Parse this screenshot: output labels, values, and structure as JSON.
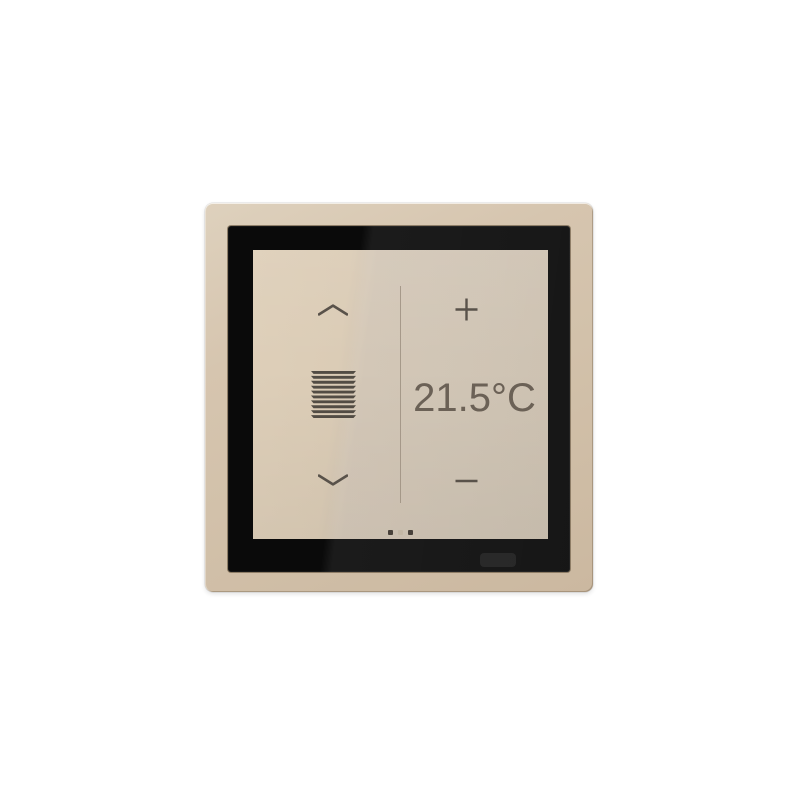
{
  "device": {
    "type": "knx-room-controller-touch-panel",
    "panes": {
      "blinds": {
        "up_icon": "chevron-up-icon",
        "state_icon": "venetian-blinds-icon",
        "down_icon": "chevron-down-icon"
      },
      "climate": {
        "increase_icon": "plus-icon",
        "temperature_value": "21.5°C",
        "decrease_icon": "minus-icon"
      }
    },
    "page_indicator": {
      "count": 3,
      "dots": [
        "dark",
        "light",
        "dark"
      ]
    },
    "sensor": "proximity-sensor-window",
    "colors": {
      "page_background": "#ffffff",
      "frame": "#d4c3ad",
      "bezel": "#0a0a0a",
      "screen_light": "#dccdb7",
      "screen_dark": "#ccc0af",
      "glyph": "#59524a",
      "temperature_text": "#6b6156",
      "divider": "#9e9181",
      "dot_dark": "#48413a",
      "dot_light": "#c3b7a5"
    }
  }
}
